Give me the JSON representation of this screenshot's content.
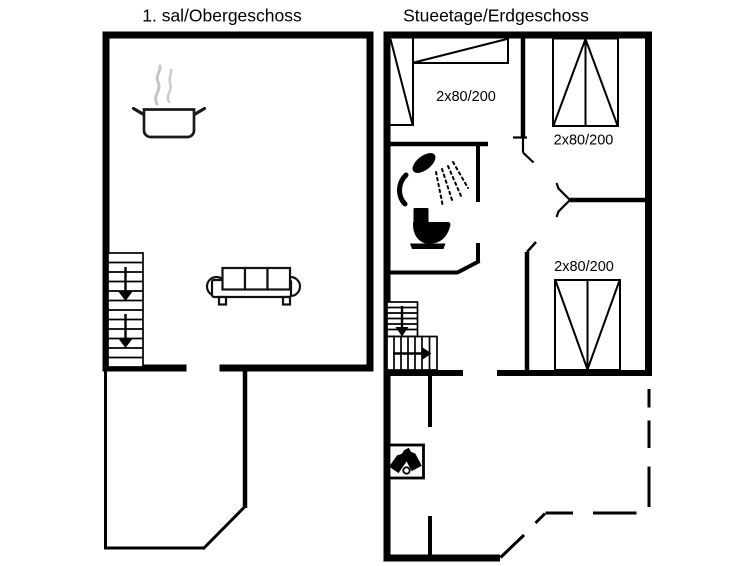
{
  "canvas": {
    "background": "#ffffff",
    "ink": "#000000",
    "steam_color": "#c5c5c5"
  },
  "left_plan": {
    "title": "1. sal/Obergeschoss",
    "icons": {
      "pot": "cooking-pot-icon",
      "sofa": "sofa-icon",
      "stairs": "staircase-down-icon"
    },
    "stairs": {
      "direction": "down",
      "arrow_count": 2
    }
  },
  "right_plan": {
    "title": "Stueetage/Erdgeschoss",
    "wardrobe_labels": [
      "2x80/200",
      "2x80/200",
      "2x80/200"
    ],
    "icons": {
      "shower": "shower-icon",
      "toilet": "toilet-icon",
      "stairs": "staircase-turn-icon",
      "wine": "wine-bottles-icon"
    },
    "stairs": {
      "direction": "down-then-right",
      "arrow_count": 2
    }
  }
}
